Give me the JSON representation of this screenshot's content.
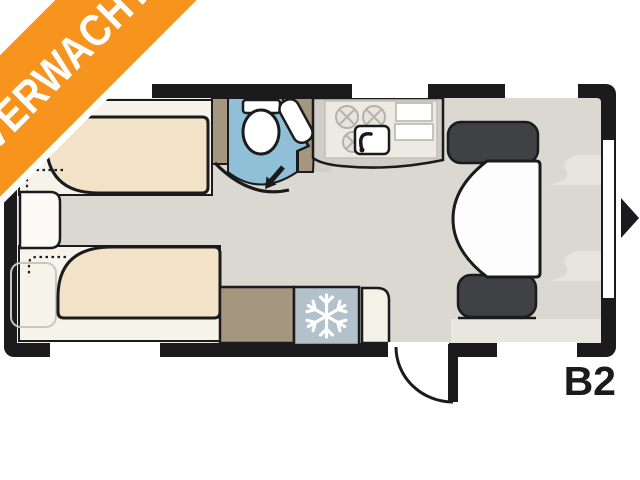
{
  "ribbon": {
    "label": "VERWACHT"
  },
  "plan": {
    "model_label": "B2",
    "type": "caravan-floorplan",
    "features": [
      "twin single beds",
      "bedside cabinet",
      "washroom with toilet and corner basin",
      "kitchen with hob, sink and worktop",
      "wardrobe",
      "fridge-freezer",
      "dinette with two bench seats and table",
      "entrance door with swing arc",
      "entry direction arrow",
      "six windows"
    ]
  },
  "icons": {
    "snowflake": "fridge-freezer marker",
    "door_arrow": "bathroom door direction",
    "entry_arrow": "entrance side marker"
  },
  "colors": {
    "ribbon_orange": "#f7941d",
    "ribbon_text": "#ffffff",
    "outline_black": "#1b1b1d",
    "floor_gray": "#dbd8d1",
    "bedroom_cream": "#f1eee5",
    "mattress_beige": "#f2e3c8",
    "bathroom_blue": "#8fc0d8",
    "wood_taupe": "#a5967f",
    "fridge_blue_gray": "#b3c1cb",
    "seat_dark_gray": "#404145",
    "window_white": "#ffffff"
  }
}
